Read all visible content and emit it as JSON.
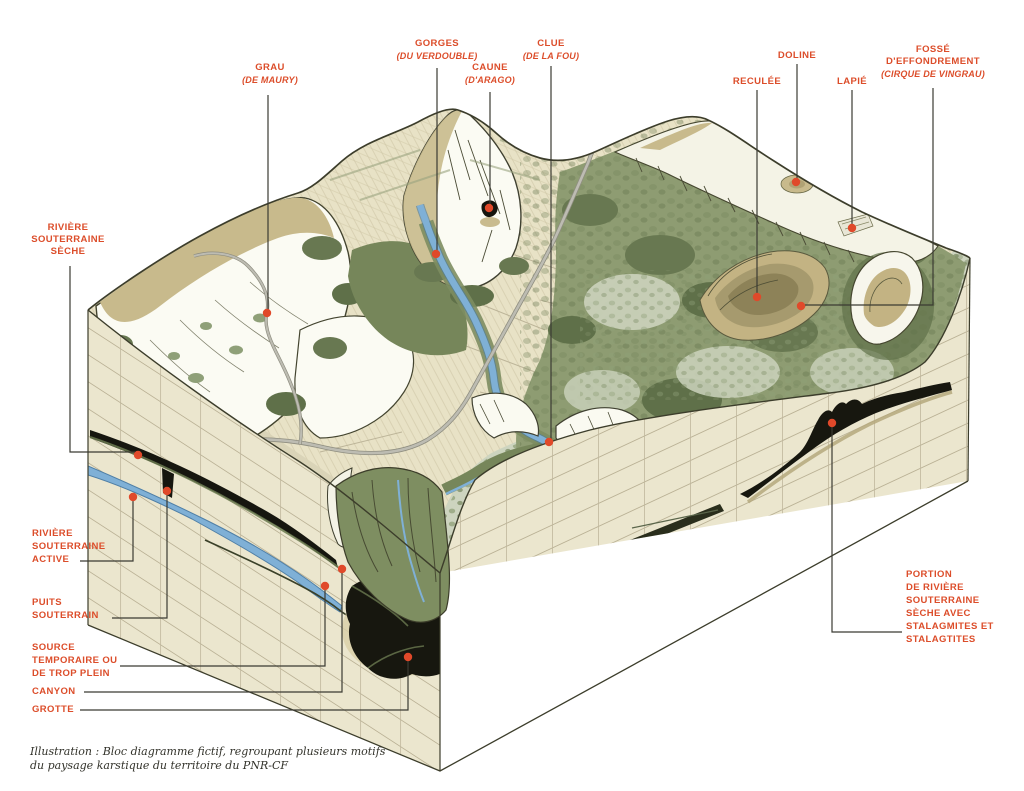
{
  "diagram": {
    "title": "Bloc diagramme du paysage karstique",
    "caption": "Illustration : Bloc diagramme fictif, regroupant plusieurs motifs\ndu paysage karstique du territoire du PNR-CF"
  },
  "labels": {
    "grau": {
      "title": "GRAU",
      "sub": "(DE MAURY)"
    },
    "gorges": {
      "title": "GORGES",
      "sub": "(DU VERDOUBLE)"
    },
    "caune": {
      "title": "CAUNE",
      "sub": "(D'ARAGO)"
    },
    "clue": {
      "title": "CLUE",
      "sub": "(DE LA FOU)"
    },
    "reculee": {
      "title": "RECULÉE"
    },
    "doline": {
      "title": "DOLINE"
    },
    "lapie": {
      "title": "LAPIÉ"
    },
    "fosse": {
      "title": "FOSSÉ\nD'EFFONDREMENT",
      "sub": "(CIRQUE DE VINGRAU)"
    },
    "riviere_souterraine_seche": {
      "title": "RIVIÈRE\nSOUTERRAINE\nSÈCHE"
    },
    "riviere_souterraine_active": {
      "title": "RIVIÈRE\nSOUTERRAINE\nACTIVE"
    },
    "puits_souterrain": {
      "title": "PUITS\nSOUTERRAIN"
    },
    "source_temporaire": {
      "title": "SOURCE\nTEMPORAIRE OU\nDE TROP PLEIN"
    },
    "canyon": {
      "title": "CANYON"
    },
    "grotte": {
      "title": "GROTTE"
    },
    "portion_riviere": {
      "title": "PORTION\nDE RIVIÈRE\nSOUTERRAINE\nSÈCHE AVEC\nSTALAGMITES ET\nSTALAGTITES"
    }
  },
  "colors": {
    "label_red": "#dc4d2a",
    "dot_red": "#e0492a",
    "leader_ink": "#3b3b33",
    "caption_ink": "#33332b",
    "face_cream": "#ebe6ce",
    "grid_line": "#b2a98c",
    "top_cream": "#e8e2c6",
    "sage": "#ccd3bd",
    "forest": "#8e9c72",
    "forest_dark": "#687851",
    "tan": "#c8ba8c",
    "rock_white": "#fafaf1",
    "outline": "#3c3d2b",
    "river_blue": "#7fb0d6",
    "road_grey": "#b9b8ae",
    "cave_black": "#16160f"
  }
}
